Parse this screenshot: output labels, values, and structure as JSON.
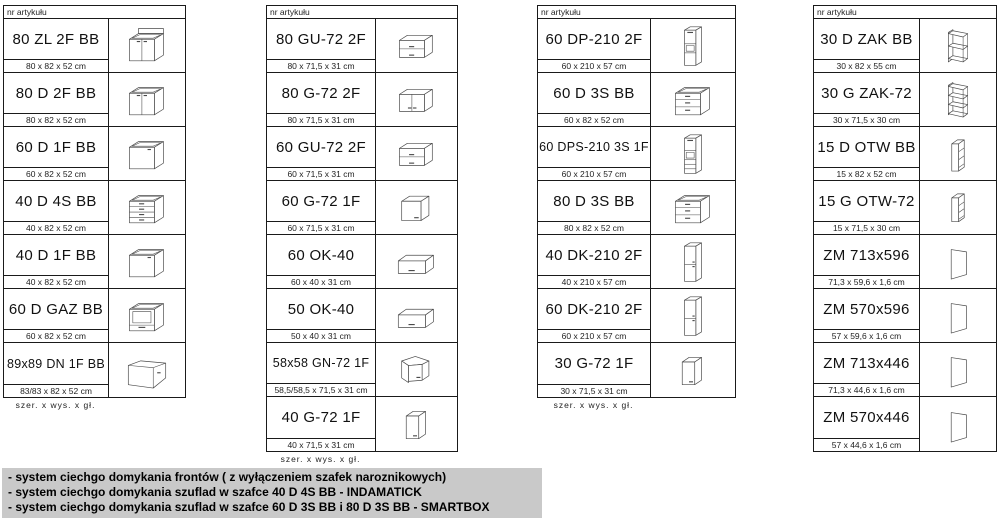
{
  "header_label": "nr artykułu",
  "footer_label": "szer.  x  wys.  x  gł.",
  "colors": {
    "border": "#1a1a1a",
    "notes_bg": "#c9c9c9",
    "icon_stroke": "#4a4a4a"
  },
  "tables": [
    {
      "name": "base-cabinets",
      "show_footer": true,
      "rows": [
        {
          "code": "80 ZL 2F BB",
          "dims": "80 x 82 x 52 cm",
          "icon": "base-sink-2door"
        },
        {
          "code": "80 D 2F BB",
          "dims": "80 x 82 x 52 cm",
          "icon": "base-2door"
        },
        {
          "code": "60 D 1F BB",
          "dims": "60 x 82 x 52 cm",
          "icon": "base-1door"
        },
        {
          "code": "40 D 4S BB",
          "dims": "40 x 82 x 52 cm",
          "icon": "base-4drawer"
        },
        {
          "code": "40 D 1F BB",
          "dims": "40 x 82 x 52 cm",
          "icon": "base-1door"
        },
        {
          "code": "60 D GAZ BB",
          "dims": "60 x 82 x 52 cm",
          "icon": "base-oven"
        },
        {
          "code": "89x89 DN 1F BB",
          "dims": "83/83 x 82 x 52 cm",
          "icon": "base-corner"
        }
      ]
    },
    {
      "name": "wall-cabinets",
      "show_footer": true,
      "rows": [
        {
          "code": "80 GU-72 2F",
          "dims": "80 x 71,5 x 31 cm",
          "icon": "wall-2flap"
        },
        {
          "code": "80 G-72 2F",
          "dims": "80 x 71,5 x 31 cm",
          "icon": "wall-2door"
        },
        {
          "code": "60 GU-72 2F",
          "dims": "60 x 71,5 x 31 cm",
          "icon": "wall-2flap"
        },
        {
          "code": "60 G-72 1F",
          "dims": "60 x 71,5 x 31 cm",
          "icon": "wall-1door"
        },
        {
          "code": "60 OK-40",
          "dims": "60 x 40 x 31 cm",
          "icon": "wall-flap"
        },
        {
          "code": "50 OK-40",
          "dims": "50 x 40 x 31 cm",
          "icon": "wall-flap"
        },
        {
          "code": "58x58 GN-72 1F",
          "dims": "58,5/58,5 x 71,5 x 31 cm",
          "icon": "wall-corner"
        },
        {
          "code": "40 G-72 1F",
          "dims": "40 x 71,5 x 31 cm",
          "icon": "wall-1door-narrow"
        }
      ]
    },
    {
      "name": "tall-and-drawer-cabinets",
      "show_footer": true,
      "rows": [
        {
          "code": "60 DP-210 2F",
          "dims": "60 x 210 x 57 cm",
          "icon": "tall-oven"
        },
        {
          "code": "60 D 3S BB",
          "dims": "60 x 82 x 52 cm",
          "icon": "base-3drawer"
        },
        {
          "code": "60 DPS-210 3S 1F",
          "dims": "60 x 210 x 57 cm",
          "icon": "tall-oven-drawers"
        },
        {
          "code": "80 D 3S BB",
          "dims": "80 x 82 x 52 cm",
          "icon": "base-3drawer"
        },
        {
          "code": "40 DK-210 2F",
          "dims": "40 x 210 x 57 cm",
          "icon": "tall-2door"
        },
        {
          "code": "60 DK-210 2F",
          "dims": "60 x 210 x 57 cm",
          "icon": "tall-2door"
        },
        {
          "code": "30 G-72 1F",
          "dims": "30 x 71,5 x 31 cm",
          "icon": "wall-1door-narrow"
        }
      ]
    },
    {
      "name": "open-shelves-and-panels",
      "show_footer": false,
      "rows": [
        {
          "code": "30 D ZAK BB",
          "dims": "30 x 82 x 55 cm",
          "icon": "end-shelf-base"
        },
        {
          "code": "30 G ZAK-72",
          "dims": "30 x 71,5 x 30 cm",
          "icon": "end-shelf-wall"
        },
        {
          "code": "15 D OTW BB",
          "dims": "15 x 82 x 52 cm",
          "icon": "open-narrow-base"
        },
        {
          "code": "15 G OTW-72",
          "dims": "15 x 71,5 x 30 cm",
          "icon": "open-narrow-wall"
        },
        {
          "code": "ZM 713x596",
          "dims": "71,3 x 59,6 x 1,6 cm",
          "icon": "panel"
        },
        {
          "code": "ZM 570x596",
          "dims": "57 x 59,6 x 1,6 cm",
          "icon": "panel"
        },
        {
          "code": "ZM 713x446",
          "dims": "71,3 x 44,6 x 1,6 cm",
          "icon": "panel"
        },
        {
          "code": "ZM 570x446",
          "dims": "57 x 44,6 x 1,6 cm",
          "icon": "panel"
        }
      ]
    }
  ],
  "notes": {
    "lines": [
      "- system ciechgo domykania frontów ( z wyłączeniem szafek naroznikowych)",
      "- system ciechgo domykania szuflad w szafce 40 D 4S BB - INDAMATICK",
      "- system ciechgo domykania szuflad w szafce 60 D 3S BB i 80 D 3S BB - SMARTBOX"
    ]
  }
}
